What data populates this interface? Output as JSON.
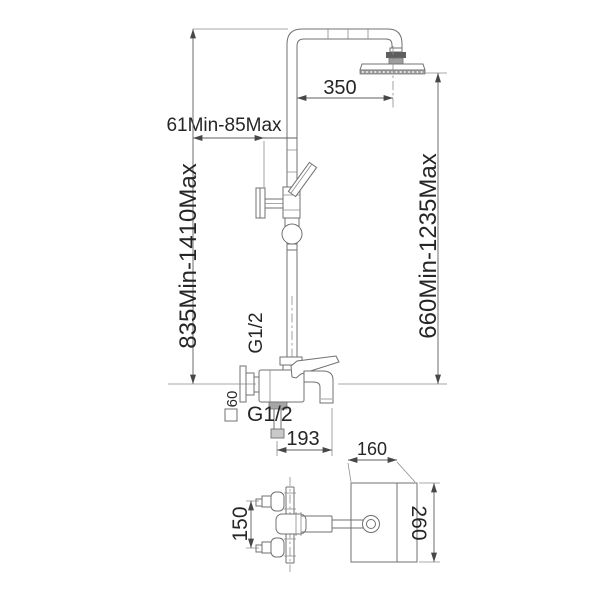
{
  "canvas": {
    "width": 600,
    "height": 600,
    "background": "#ffffff"
  },
  "palette": {
    "object_line": "#707070",
    "dimension_line": "#5f5f5f",
    "extension_line": "#8c8c8c",
    "arrow": "#474747",
    "text": "#262626",
    "connector_dark": "#5e5e5e",
    "connector_mid": "#9e9e9e"
  },
  "front_view": {
    "dims": {
      "arm_reach": "350",
      "holder_offset": "61Min-85Max",
      "overall_height": "835Min-1410Max",
      "head_height": "660Min-1235Max",
      "riser_thread": "G1/2",
      "outlet_thread": "G1/2",
      "wall_plate_size": "60",
      "wall_plate_symbol": "□",
      "spout_reach": "193"
    }
  },
  "top_view": {
    "dims": {
      "plate_width": "160",
      "plate_depth": "260",
      "inlet_spacing": "150"
    }
  }
}
